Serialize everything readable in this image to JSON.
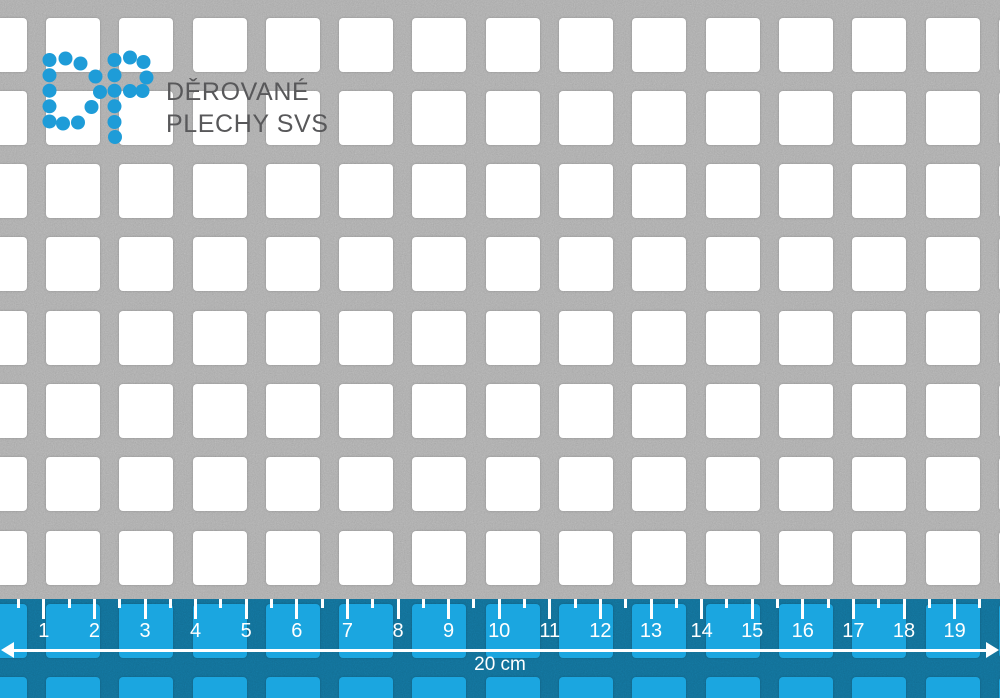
{
  "logo": {
    "monogram": "DP",
    "line1": "DĚROVANÉ",
    "line2": "PLECHY SVS",
    "dot_color": "#1E9CD8",
    "text_color": "#58585A",
    "dot_radius": 7,
    "dots_d": [
      [
        49.5,
        60
      ],
      [
        65.5,
        58.5
      ],
      [
        80.5,
        63.5
      ],
      [
        95.5,
        76.5
      ],
      [
        100,
        92
      ],
      [
        91.5,
        107
      ],
      [
        78,
        122.5
      ],
      [
        63,
        123.5
      ],
      [
        49.5,
        121.5
      ],
      [
        49.5,
        106.3
      ],
      [
        49.5,
        90.7
      ],
      [
        49.5,
        75.3
      ]
    ],
    "dots_p": [
      [
        114.5,
        60
      ],
      [
        114.5,
        75.3
      ],
      [
        114.5,
        90.7
      ],
      [
        114.5,
        106.3
      ],
      [
        114.5,
        122
      ],
      [
        115,
        137
      ],
      [
        130,
        57.5
      ],
      [
        143.5,
        62
      ],
      [
        146.5,
        77.5
      ],
      [
        142.5,
        91
      ],
      [
        130,
        91
      ]
    ]
  },
  "sheet": {
    "metal_color": "#B0B0B0",
    "hole_color": "#FFFFFF",
    "pitch": 73.3,
    "hole_size": 54,
    "first_col_x": -27.4,
    "first_row_y": 17.5,
    "cols": 15,
    "rows": 10
  },
  "ruler": {
    "numbers": [
      "1",
      "2",
      "3",
      "4",
      "5",
      "6",
      "7",
      "8",
      "9",
      "10",
      "11",
      "12",
      "13",
      "14",
      "15",
      "16",
      "17",
      "18",
      "19"
    ],
    "caption": "20 cm",
    "overlay_color": "#1BA6E0",
    "mark_color": "#FFFFFF",
    "origin_x": 43.8,
    "cm_px": 50.6
  }
}
